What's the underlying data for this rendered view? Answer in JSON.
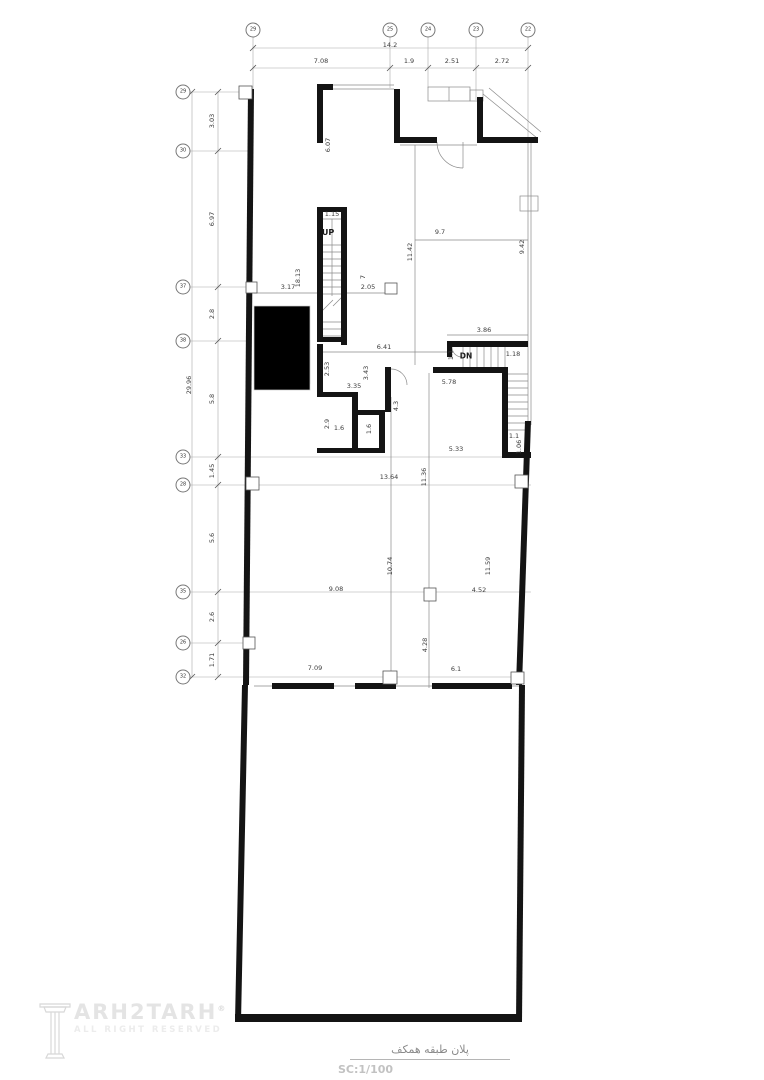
{
  "title_block": {
    "title_fa": "پلان طبقه همکف",
    "scale_label": "SC:1/100"
  },
  "logo": {
    "brand": "ARH2TARH",
    "registered": "®",
    "tagline": "ALL RIGHT RESERVED"
  },
  "colors": {
    "wall": "#141414",
    "thin_line": "#8a8a8a",
    "grid_line": "#a8a8a8",
    "stair_gray": "#bdbdbd",
    "dim_text": "#3c3c3c"
  },
  "grid": {
    "top_bubbles": [
      {
        "label": "29",
        "x": 253,
        "y": 30
      },
      {
        "label": "25",
        "x": 390,
        "y": 30
      },
      {
        "label": "24",
        "x": 428,
        "y": 30
      },
      {
        "label": "23",
        "x": 476,
        "y": 30
      },
      {
        "label": "22",
        "x": 528,
        "y": 30
      }
    ],
    "left_bubbles": [
      {
        "label": "29",
        "x": 183,
        "y": 92
      },
      {
        "label": "30",
        "x": 183,
        "y": 151
      },
      {
        "label": "37",
        "x": 183,
        "y": 287
      },
      {
        "label": "38",
        "x": 183,
        "y": 341
      },
      {
        "label": "33",
        "x": 183,
        "y": 457
      },
      {
        "label": "28",
        "x": 183,
        "y": 485
      },
      {
        "label": "35",
        "x": 183,
        "y": 592
      },
      {
        "label": "26",
        "x": 183,
        "y": 643
      },
      {
        "label": "32",
        "x": 183,
        "y": 677
      }
    ]
  },
  "annotations": [
    {
      "v": "14.2",
      "x": 390,
      "y": 45
    },
    {
      "v": "7.08",
      "x": 321,
      "y": 61
    },
    {
      "v": "1.9",
      "x": 409,
      "y": 61
    },
    {
      "v": "2.51",
      "x": 452,
      "y": 61
    },
    {
      "v": "2.72",
      "x": 502,
      "y": 61
    },
    {
      "v": "29.96",
      "x": 189,
      "y": 385,
      "rot": 1
    },
    {
      "v": "3.03",
      "x": 212,
      "y": 121,
      "rot": 1
    },
    {
      "v": "6.97",
      "x": 212,
      "y": 219,
      "rot": 1
    },
    {
      "v": "2.8",
      "x": 212,
      "y": 314,
      "rot": 1
    },
    {
      "v": "5.8",
      "x": 212,
      "y": 399,
      "rot": 1
    },
    {
      "v": "1.45",
      "x": 212,
      "y": 471,
      "rot": 1
    },
    {
      "v": "5.6",
      "x": 212,
      "y": 538,
      "rot": 1
    },
    {
      "v": "2.6",
      "x": 212,
      "y": 617,
      "rot": 1
    },
    {
      "v": "1.71",
      "x": 212,
      "y": 660,
      "rot": 1
    },
    {
      "v": "6.07",
      "x": 328,
      "y": 145,
      "rot": 1
    },
    {
      "v": "1.15",
      "x": 332,
      "y": 214
    },
    {
      "v": "UP",
      "x": 328,
      "y": 233,
      "size": 8,
      "flag": 1
    },
    {
      "v": "9.7",
      "x": 440,
      "y": 232
    },
    {
      "v": "11.42",
      "x": 410,
      "y": 252,
      "rot": 1
    },
    {
      "v": "9.42",
      "x": 522,
      "y": 247,
      "rot": 1
    },
    {
      "v": "3.17",
      "x": 288,
      "y": 287
    },
    {
      "v": "18.13",
      "x": 298,
      "y": 278,
      "rot": 1
    },
    {
      "v": "7",
      "x": 363,
      "y": 277,
      "rot": 1
    },
    {
      "v": "2.05",
      "x": 368,
      "y": 287
    },
    {
      "v": "3.86",
      "x": 484,
      "y": 330
    },
    {
      "v": "6.41",
      "x": 384,
      "y": 347
    },
    {
      "v": "1.1",
      "x": 451,
      "y": 355,
      "rot": 1
    },
    {
      "v": "DN",
      "x": 466,
      "y": 356,
      "size": 7.5,
      "flag": 1
    },
    {
      "v": "1.18",
      "x": 513,
      "y": 354
    },
    {
      "v": "2.53",
      "x": 327,
      "y": 369,
      "rot": 1
    },
    {
      "v": "3.43",
      "x": 366,
      "y": 373,
      "rot": 1
    },
    {
      "v": "3.35",
      "x": 354,
      "y": 386
    },
    {
      "v": "5.78",
      "x": 449,
      "y": 382
    },
    {
      "v": "4.3",
      "x": 396,
      "y": 406,
      "rot": 1
    },
    {
      "v": "2.9",
      "x": 327,
      "y": 424,
      "rot": 1
    },
    {
      "v": "1.6",
      "x": 339,
      "y": 428
    },
    {
      "v": "1.6",
      "x": 369,
      "y": 429,
      "rot": 1
    },
    {
      "v": "5.33",
      "x": 456,
      "y": 449
    },
    {
      "v": "1.1",
      "x": 514,
      "y": 436
    },
    {
      "v": "1.06",
      "x": 519,
      "y": 447,
      "rot": 1
    },
    {
      "v": "13.64",
      "x": 389,
      "y": 477
    },
    {
      "v": "11.36",
      "x": 424,
      "y": 477,
      "rot": 1
    },
    {
      "v": "9.08",
      "x": 336,
      "y": 589
    },
    {
      "v": "10.74",
      "x": 390,
      "y": 566,
      "rot": 1
    },
    {
      "v": "11.59",
      "x": 488,
      "y": 566,
      "rot": 1
    },
    {
      "v": "4.52",
      "x": 479,
      "y": 590
    },
    {
      "v": "4.28",
      "x": 425,
      "y": 645,
      "rot": 1
    },
    {
      "v": "7.09",
      "x": 315,
      "y": 668
    },
    {
      "v": "6.1",
      "x": 456,
      "y": 669
    }
  ]
}
